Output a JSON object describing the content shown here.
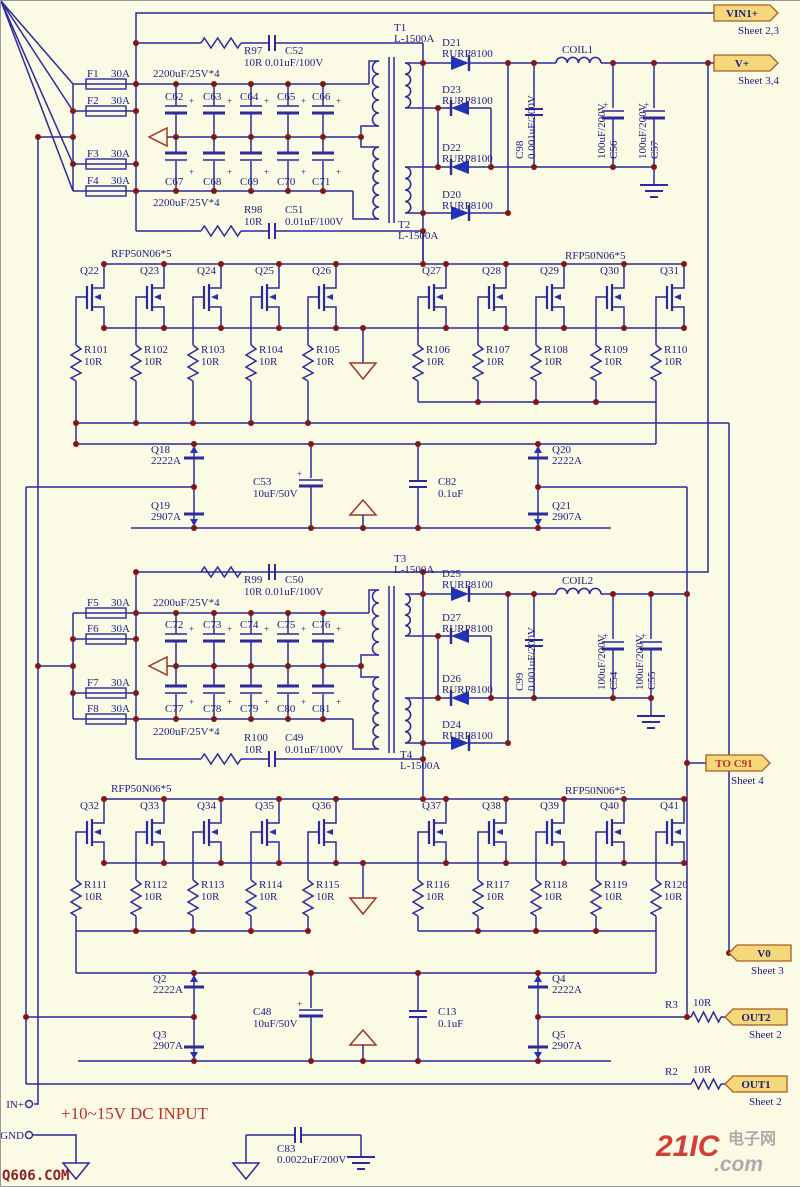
{
  "colors": {
    "background": "#fbfae4",
    "wire": "#2b2b9e",
    "label": "#1d1d85",
    "junction": "#801818",
    "accent_red": "#a03525",
    "flag_fill": "#f5d87a",
    "flag_border": "#a85c28",
    "note_red": "#c03028"
  },
  "note": "+10~15V DC INPUT",
  "watermark": "Q606.COM",
  "logo": {
    "red": "21IC",
    "cn": "电子网",
    "dotcom": ".com"
  },
  "terminals": [
    {
      "label": "IN+"
    },
    {
      "label": "GND"
    }
  ],
  "flags": [
    {
      "label": "VIN1+",
      "sheet": "Sheet 2,3"
    },
    {
      "label": "V+",
      "sheet": "Sheet 3,4"
    },
    {
      "label": "TO C91",
      "sheet": "Sheet 4"
    },
    {
      "label": "V0",
      "sheet": "Sheet 3"
    },
    {
      "label": "OUT2",
      "sheet": "Sheet 2"
    },
    {
      "label": "OUT1",
      "sheet": "Sheet 2"
    }
  ],
  "fuses": [
    {
      "ref": "F1",
      "value": "30A"
    },
    {
      "ref": "F2",
      "value": "30A"
    },
    {
      "ref": "F3",
      "value": "30A"
    },
    {
      "ref": "F4",
      "value": "30A"
    },
    {
      "ref": "F5",
      "value": "30A"
    },
    {
      "ref": "F6",
      "value": "30A"
    },
    {
      "ref": "F7",
      "value": "30A"
    },
    {
      "ref": "F8",
      "value": "30A"
    }
  ],
  "bank_note": "2200uF/25V*4",
  "bank_caps": [
    "C62",
    "C63",
    "C64",
    "C65",
    "C66",
    "C67",
    "C68",
    "C69",
    "C70",
    "C71",
    "C72",
    "C73",
    "C74",
    "C75",
    "C76",
    "C77",
    "C78",
    "C79",
    "C80",
    "C81"
  ],
  "snubbers": [
    {
      "r": "R97",
      "r_value": "10R",
      "c": "C52",
      "c_value": "0.01uF/100V"
    },
    {
      "r": "R98",
      "r_value": "10R",
      "c": "C51",
      "c_value": "0.01uF/100V"
    },
    {
      "r": "R99",
      "r_value": "10R",
      "c": "C50",
      "c_value": "0.01uF/100V"
    },
    {
      "r": "R100",
      "r_value": "10R",
      "c": "C49",
      "c_value": "0.01uF/100V"
    }
  ],
  "transformers": [
    {
      "ref": "T1",
      "value": "L-1500A"
    },
    {
      "ref": "T2",
      "value": "L-1500A"
    },
    {
      "ref": "T3",
      "value": "L-1500A"
    },
    {
      "ref": "T4",
      "value": "L-1500A"
    }
  ],
  "rectifier_diodes": [
    {
      "ref": "D21",
      "value": "RURP8100"
    },
    {
      "ref": "D23",
      "value": "RURP8100"
    },
    {
      "ref": "D22",
      "value": "RURP8100"
    },
    {
      "ref": "D20",
      "value": "RURP8100"
    },
    {
      "ref": "D25",
      "value": "RURP8100"
    },
    {
      "ref": "D27",
      "value": "RURP8100"
    },
    {
      "ref": "D26",
      "value": "RURP8100"
    },
    {
      "ref": "D24",
      "value": "RURP8100"
    }
  ],
  "coils": [
    "COIL1",
    "COIL2"
  ],
  "filter_caps": [
    {
      "ref": "C98",
      "value": "0.001uF/200V"
    },
    {
      "ref": "C56",
      "value": "100uF/200V"
    },
    {
      "ref": "C57",
      "value": "100uF/200V"
    },
    {
      "ref": "C99",
      "value": "0.001uF/200V"
    },
    {
      "ref": "C54",
      "value": "100uF/200V"
    },
    {
      "ref": "C55",
      "value": "100uF/200V"
    }
  ],
  "mosfet_group": "RFP50N06*5",
  "mosfets": [
    "Q22",
    "Q23",
    "Q24",
    "Q25",
    "Q26",
    "Q27",
    "Q28",
    "Q29",
    "Q30",
    "Q31",
    "Q32",
    "Q33",
    "Q34",
    "Q35",
    "Q36",
    "Q37",
    "Q38",
    "Q39",
    "Q40",
    "Q41"
  ],
  "gate_resistors": [
    {
      "ref": "R101",
      "value": "10R"
    },
    {
      "ref": "R102",
      "value": "10R"
    },
    {
      "ref": "R103",
      "value": "10R"
    },
    {
      "ref": "R104",
      "value": "10R"
    },
    {
      "ref": "R105",
      "value": "10R"
    },
    {
      "ref": "R106",
      "value": "10R"
    },
    {
      "ref": "R107",
      "value": "10R"
    },
    {
      "ref": "R108",
      "value": "10R"
    },
    {
      "ref": "R109",
      "value": "10R"
    },
    {
      "ref": "R110",
      "value": "10R"
    },
    {
      "ref": "R111",
      "value": "10R"
    },
    {
      "ref": "R112",
      "value": "10R"
    },
    {
      "ref": "R113",
      "value": "10R"
    },
    {
      "ref": "R114",
      "value": "10R"
    },
    {
      "ref": "R115",
      "value": "10R"
    },
    {
      "ref": "R116",
      "value": "10R"
    },
    {
      "ref": "R117",
      "value": "10R"
    },
    {
      "ref": "R118",
      "value": "10R"
    },
    {
      "ref": "R119",
      "value": "10R"
    },
    {
      "ref": "R120",
      "value": "10R"
    }
  ],
  "driver_transistors": [
    {
      "ref": "Q18",
      "value": "2222A"
    },
    {
      "ref": "Q19",
      "value": "2907A"
    },
    {
      "ref": "Q20",
      "value": "2222A"
    },
    {
      "ref": "Q21",
      "value": "2907A"
    },
    {
      "ref": "Q2",
      "value": "2222A"
    },
    {
      "ref": "Q3",
      "value": "2907A"
    },
    {
      "ref": "Q4",
      "value": "2222A"
    },
    {
      "ref": "Q5",
      "value": "2907A"
    }
  ],
  "driver_caps": [
    {
      "ref": "C53",
      "value": "10uF/50V"
    },
    {
      "ref": "C82",
      "value": "0.1uF"
    },
    {
      "ref": "C48",
      "value": "10uF/50V"
    },
    {
      "ref": "C13",
      "value": "0.1uF"
    }
  ],
  "output_resistors": [
    {
      "ref": "R3",
      "value": "10R"
    },
    {
      "ref": "R2",
      "value": "10R"
    }
  ],
  "input_cap": {
    "ref": "C83",
    "value": "0.0022uF/200V"
  }
}
